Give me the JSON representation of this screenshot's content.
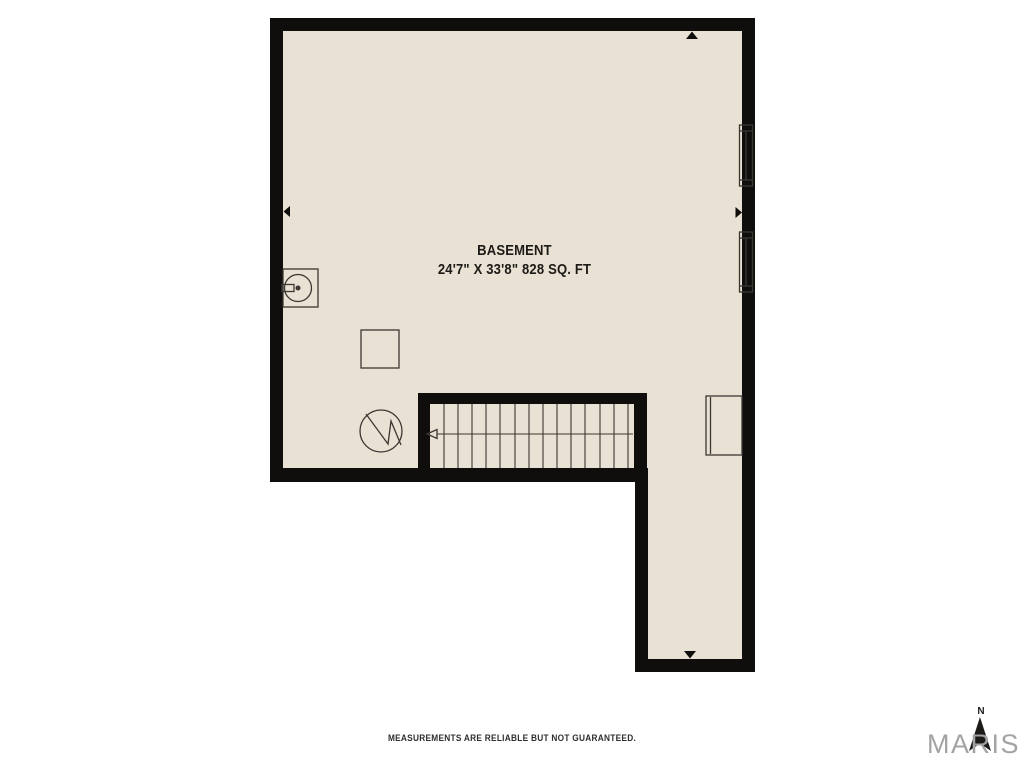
{
  "plan": {
    "room_label": "BASEMENT",
    "room_dimensions": "24'7\" X 33'8\" 828 SQ. FT",
    "stairs": {
      "direction": "left",
      "tread_count": 15
    },
    "symbols": [
      "utility-sink",
      "furnace",
      "sump-pump",
      "appliance",
      "window",
      "stairs"
    ]
  },
  "footer": {
    "disclaimer": "MEASUREMENTS ARE RELIABLE BUT NOT GUARANTEED."
  },
  "branding": {
    "logo": "MARIS",
    "compass_label": "N"
  },
  "colors": {
    "background": "#ffffff",
    "wall": "#0f0e0d",
    "floor": "#e9e1d3",
    "line": "#3b3733",
    "logo": "#a3a3a5",
    "text": "#1d1b18",
    "muted_text": "#2e2e2e"
  }
}
